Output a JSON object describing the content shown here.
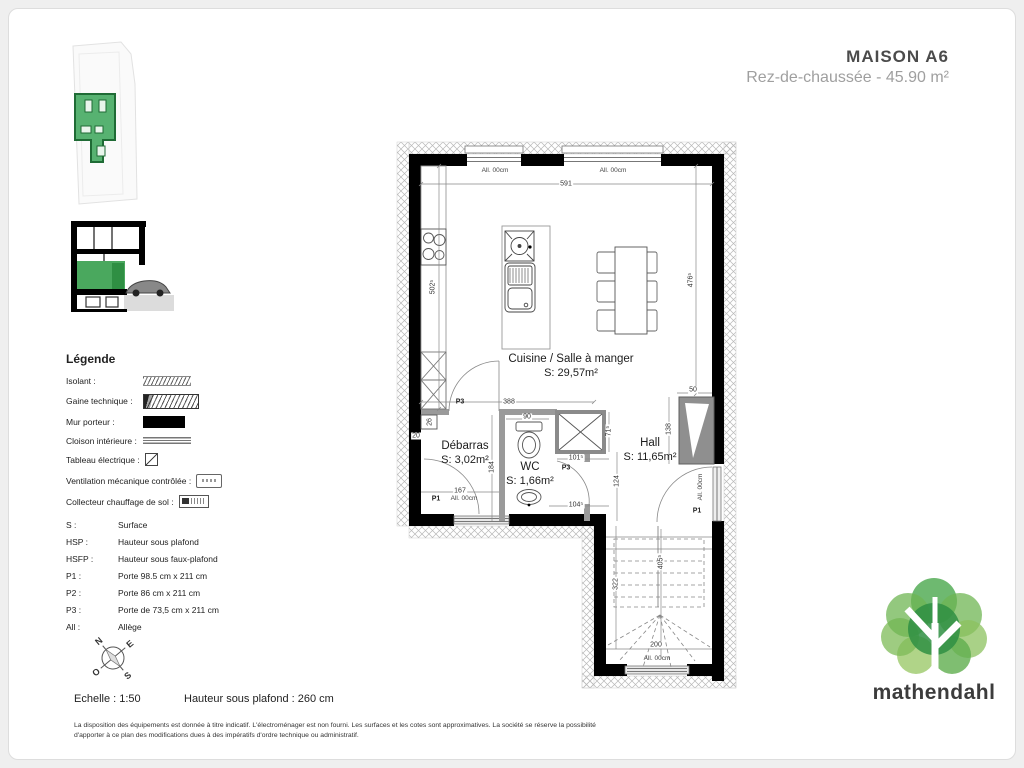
{
  "header": {
    "title": "MAISON A6",
    "subtitle": "Rez-de-chaussée - 45.90 m²"
  },
  "legend": {
    "title": "Légende",
    "symbol_items": [
      {
        "label": "Isolant :",
        "symbol": "isolant-hatch"
      },
      {
        "label": "Gaine technique :",
        "symbol": "technical-duct"
      },
      {
        "label": "Mur porteur :",
        "symbol": "load-bearing-wall"
      },
      {
        "label": "Cloison intérieure :",
        "symbol": "interior-partition"
      },
      {
        "label": "Tableau électrique :",
        "symbol": "electrical-panel"
      },
      {
        "label": "Ventilation mécanique contrôlée :",
        "symbol": "vmc-unit"
      },
      {
        "label": "Collecteur chauffage de sol :",
        "symbol": "floor-heating-manifold"
      }
    ],
    "abbrev_items": [
      {
        "abbr": "S :",
        "label": "Surface"
      },
      {
        "abbr": "HSP :",
        "label": "Hauteur sous plafond"
      },
      {
        "abbr": "HSFP :",
        "label": "Hauteur sous faux-plafond"
      },
      {
        "abbr": "P1 :",
        "label": "Porte 98.5 cm x 211 cm"
      },
      {
        "abbr": "P2 :",
        "label": "Porte 86 cm x 211 cm"
      },
      {
        "abbr": "P3 :",
        "label": "Porte de 73,5 cm x 211 cm"
      },
      {
        "abbr": "All :",
        "label": "Allège"
      }
    ]
  },
  "plan": {
    "rooms": [
      {
        "name": "Cuisine / Salle à manger",
        "surface": "S: 29,57m²"
      },
      {
        "name": "Débarras",
        "surface": "S: 3,02m²"
      },
      {
        "name": "WC",
        "surface": "S: 1,66m²"
      },
      {
        "name": "Hall",
        "surface": "S: 11,65m²"
      }
    ],
    "dims": {
      "top_width": "591",
      "left_height": "502⁵",
      "right_height": "476⁵",
      "debarras_top": "388",
      "wc_width": "90",
      "debarras_height": "184",
      "debarras_width": "167",
      "wall_offset": "20",
      "panel_width": "26",
      "gaine_height": "71⁵",
      "gaine_width": "101⁵",
      "hall_height": "124",
      "hall_width": "104⁵",
      "window_height": "138",
      "window_width": "50",
      "stair_left": "322",
      "stair_right": "405⁵",
      "stair_width": "200"
    },
    "doors": {
      "p3_debarras": "P3",
      "p3_wc": "P3",
      "p1_back": "P1",
      "p1_entry": "P1"
    },
    "windows": {
      "w_top_left": "All. 00cm",
      "w_top_right": "All. 00cm",
      "w_back": "All. 00cm",
      "w_entry": "All. 00cm",
      "w_stairs": "All. 00cm"
    }
  },
  "compass": {
    "n": "N",
    "e": "E",
    "s": "S",
    "o": "O"
  },
  "footer": {
    "scale": "Echelle : 1:50",
    "ceiling_height": "Hauteur sous plafond : 260 cm",
    "disclaimer_line1": "La disposition des équipements est donnée à titre indicatif. L'électroménager est non fourni. Les surfaces et les cotes sont approximatives. La société se réserve la possibilité",
    "disclaimer_line2": "d'apporter à ce plan des modifications dues à des impératifs d'ordre technique ou administratif."
  },
  "logo": {
    "name": "mathendahl",
    "tree_icon": "tree-logo",
    "greens": [
      "#2f8f43",
      "#55a84c",
      "#7dbb57",
      "#9cc96a"
    ]
  },
  "accent_color": "#4aa85e"
}
